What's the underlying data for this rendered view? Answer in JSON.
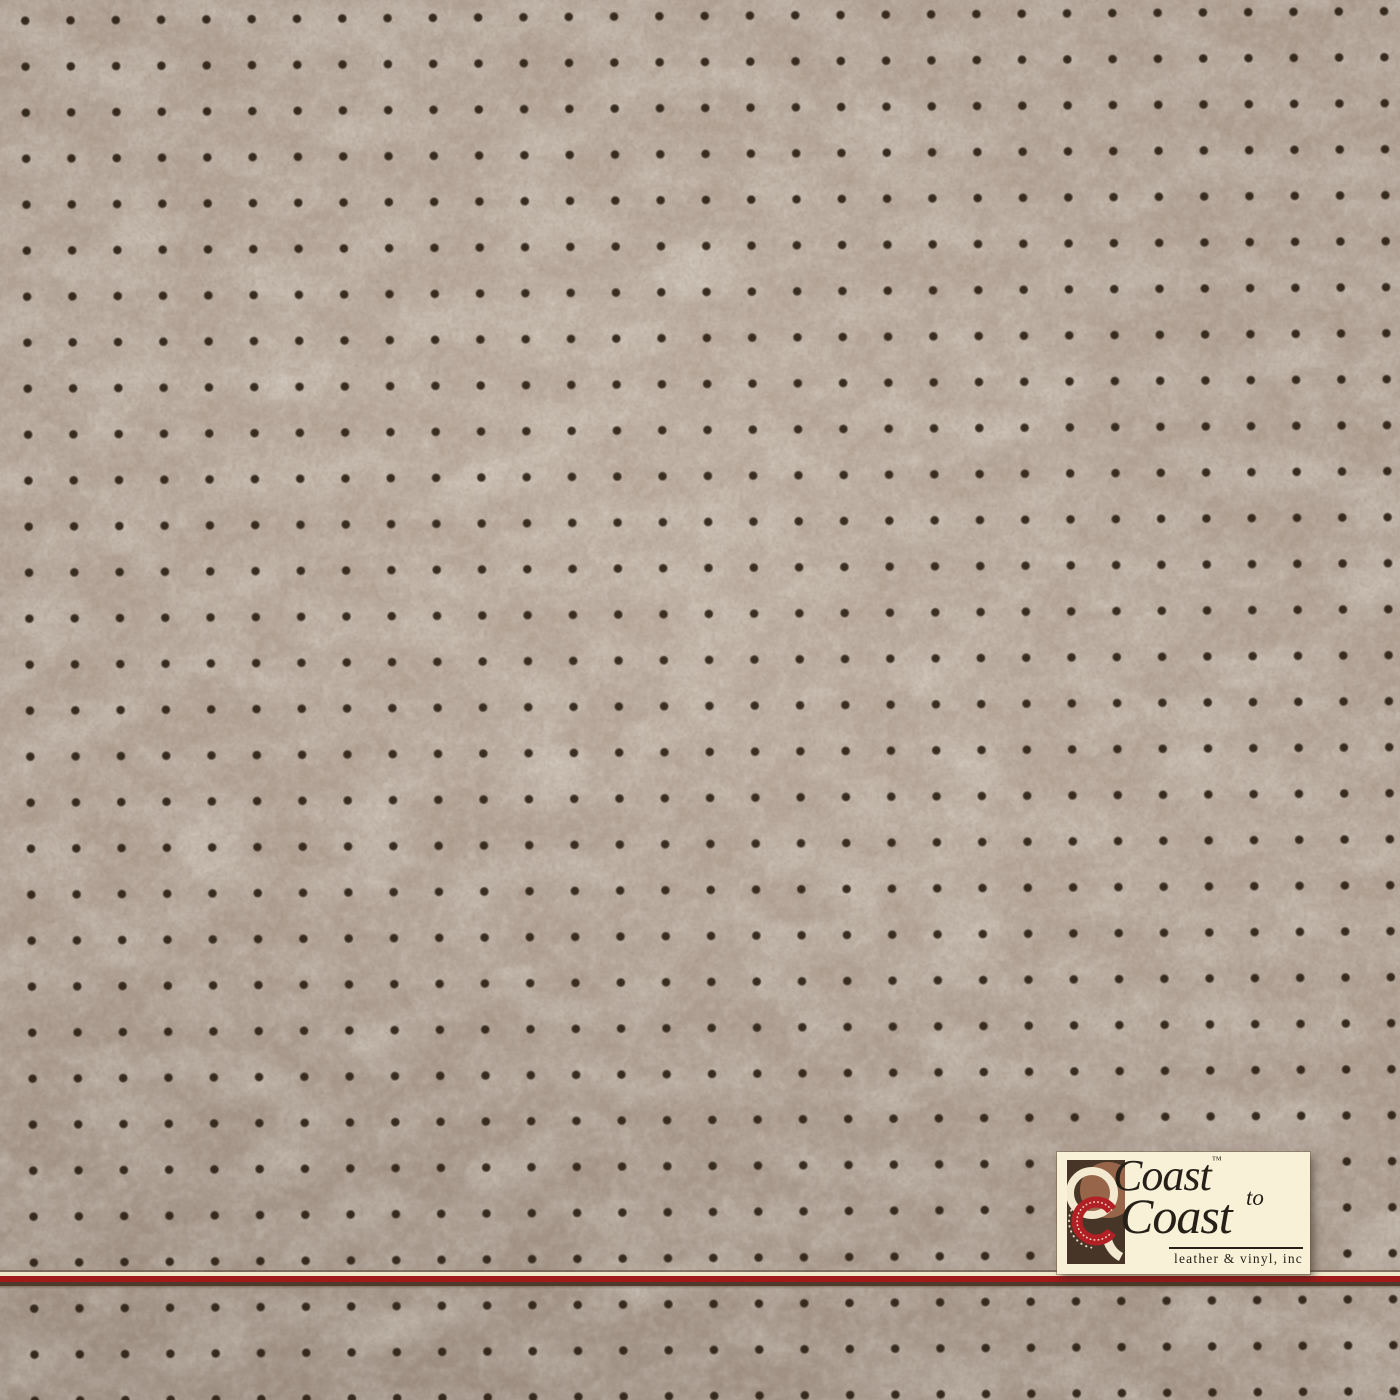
{
  "logo": {
    "brand_line1": "Coast",
    "trademark": "™",
    "connector": "to",
    "brand_line2": "Coast",
    "tagline": "leather & vinyl, inc",
    "emblem_icon": "coast-to-coast-rings-emblem"
  },
  "colors": {
    "leather_base": "#b1a194",
    "perforation_dot": "#33261a",
    "stripe_cream": "#f0e7cb",
    "stripe_red": "#a21b1b",
    "stripe_shadow": "#4e3a2a",
    "logo_background": "#f8f1d8",
    "logo_ink": "#262018",
    "emblem_background": "#473527",
    "emblem_cream": "#f2e9d0",
    "emblem_sienna": "#97664a",
    "emblem_red": "#b02025"
  },
  "pattern": {
    "dot_spacing_x": "45.3px",
    "dot_spacing_y": "46px",
    "dot_radius": "4.5px",
    "grid_rotation": "-0.4deg"
  }
}
